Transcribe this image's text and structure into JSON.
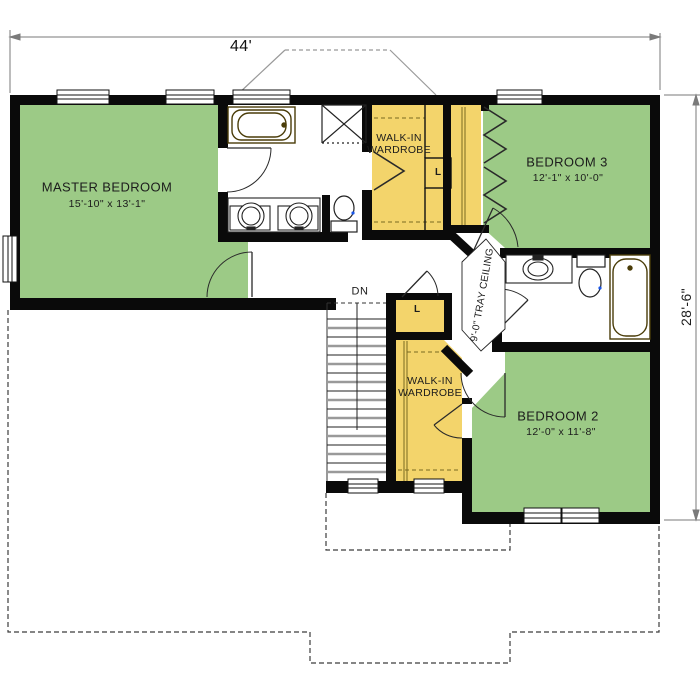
{
  "floor_plan": {
    "dimensions": {
      "overall_width": "44'",
      "overall_depth": "28'-6\""
    },
    "rooms": [
      {
        "name": "MASTER BEDROOM",
        "size": "15'-10\" x 13'-1\""
      },
      {
        "name": "BEDROOM 3",
        "size": "12'-1\" x 10'-0\""
      },
      {
        "name": "BEDROOM 2",
        "size": "12'-0\" x 11'-8\""
      }
    ],
    "closets": {
      "top_line1": "WALK-IN",
      "top_line2": "WARDROBE",
      "bottom_line1": "WALK-IN",
      "bottom_line2": "WARDROBE",
      "linen_top": "L",
      "linen_bottom": "L"
    },
    "annotations": {
      "stairs_down": "DN",
      "tray_ceiling": "9'-0\" TRAY CEILING"
    },
    "colors": {
      "bedroom_fill": "#9cca86",
      "closet_fill": "#f3d46b",
      "wall": "#0a0a0a",
      "dimension_line": "#7a7a7a",
      "fixture_brown": "#4a3c08",
      "toilet_accent": "#1a56e8"
    }
  }
}
